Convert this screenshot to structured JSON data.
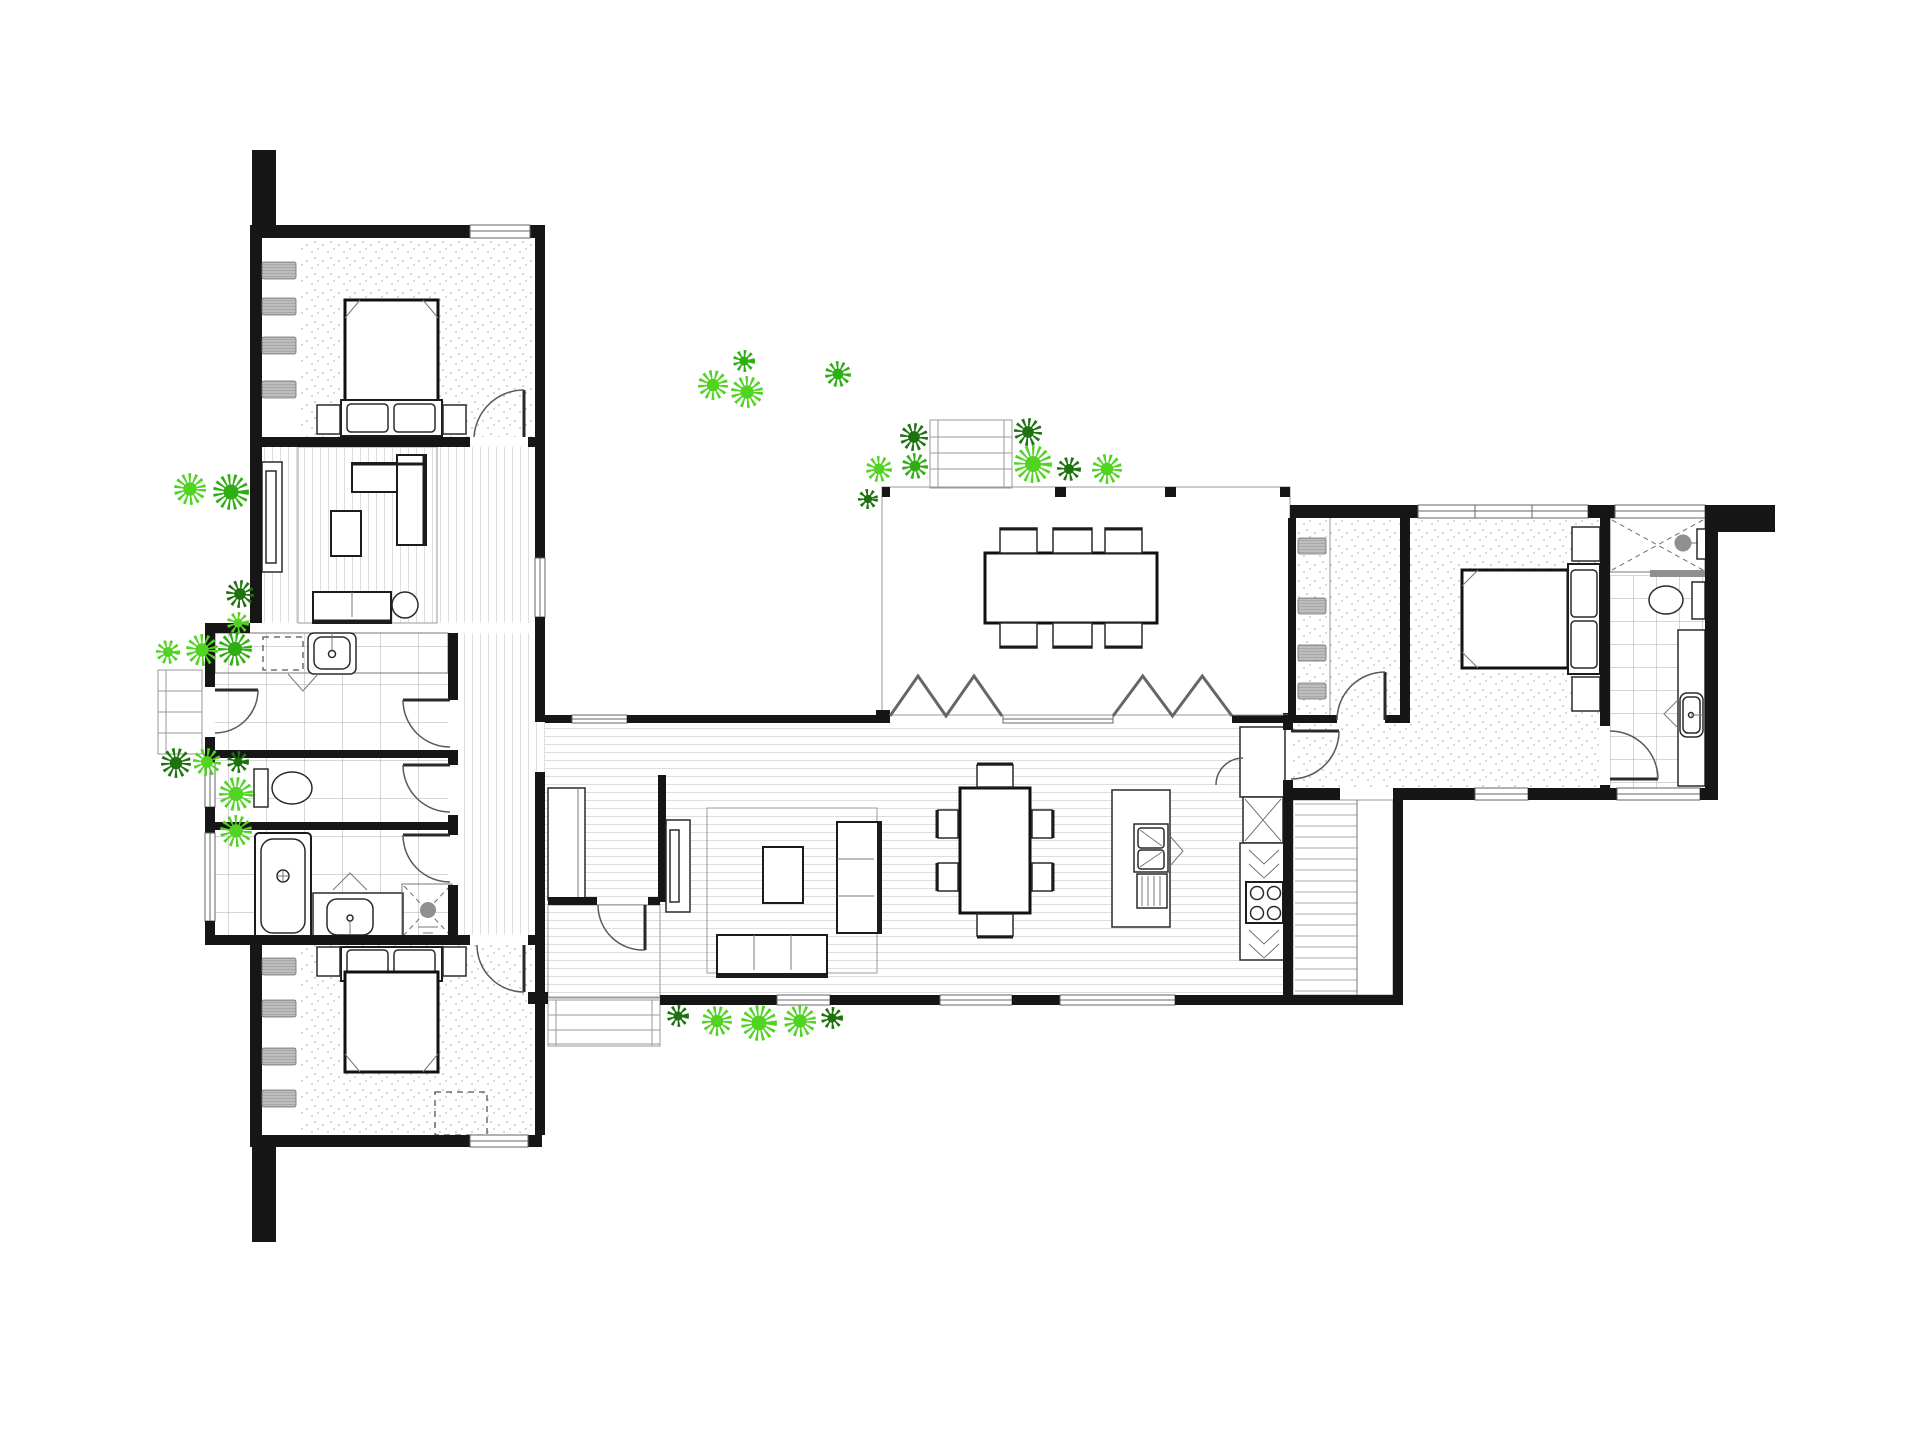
{
  "document": {
    "kind": "architectural floor plan",
    "background": "#ffffff"
  },
  "palette": {
    "wall": "#161616",
    "board": "#c3c3c3",
    "deck": "#b5b5b5",
    "tile": "#aeaeae",
    "carpet_dot": "#c9c9c9",
    "fixture_dark": "#8f8f8f",
    "plant_light": "#50d321",
    "plant_mid": "#2eae12",
    "plant_dark": "#1d730d"
  },
  "plants": [
    {
      "x": 190,
      "y": 489,
      "r": 16,
      "shade": "light"
    },
    {
      "x": 231,
      "y": 492,
      "r": 18,
      "shade": "mid"
    },
    {
      "x": 240,
      "y": 594,
      "r": 14,
      "shade": "dark"
    },
    {
      "x": 238,
      "y": 623,
      "r": 11,
      "shade": "light"
    },
    {
      "x": 168,
      "y": 652,
      "r": 12,
      "shade": "light"
    },
    {
      "x": 202,
      "y": 650,
      "r": 16,
      "shade": "light"
    },
    {
      "x": 235,
      "y": 649,
      "r": 17,
      "shade": "mid"
    },
    {
      "x": 176,
      "y": 763,
      "r": 15,
      "shade": "dark"
    },
    {
      "x": 207,
      "y": 762,
      "r": 14,
      "shade": "light"
    },
    {
      "x": 238,
      "y": 762,
      "r": 11,
      "shade": "dark"
    },
    {
      "x": 236,
      "y": 794,
      "r": 17,
      "shade": "light"
    },
    {
      "x": 236,
      "y": 831,
      "r": 16,
      "shade": "light"
    },
    {
      "x": 713,
      "y": 385,
      "r": 15,
      "shade": "light"
    },
    {
      "x": 744,
      "y": 361,
      "r": 11,
      "shade": "mid"
    },
    {
      "x": 747,
      "y": 392,
      "r": 16,
      "shade": "light"
    },
    {
      "x": 838,
      "y": 374,
      "r": 13,
      "shade": "mid"
    },
    {
      "x": 914,
      "y": 437,
      "r": 14,
      "shade": "dark"
    },
    {
      "x": 879,
      "y": 469,
      "r": 13,
      "shade": "light"
    },
    {
      "x": 915,
      "y": 466,
      "r": 13,
      "shade": "mid"
    },
    {
      "x": 868,
      "y": 499,
      "r": 10,
      "shade": "dark"
    },
    {
      "x": 1028,
      "y": 432,
      "r": 14,
      "shade": "dark"
    },
    {
      "x": 1033,
      "y": 464,
      "r": 19,
      "shade": "light"
    },
    {
      "x": 1069,
      "y": 469,
      "r": 12,
      "shade": "dark"
    },
    {
      "x": 1107,
      "y": 469,
      "r": 15,
      "shade": "light"
    },
    {
      "x": 678,
      "y": 1016,
      "r": 11,
      "shade": "dark"
    },
    {
      "x": 717,
      "y": 1021,
      "r": 15,
      "shade": "light"
    },
    {
      "x": 759,
      "y": 1023,
      "r": 18,
      "shade": "light"
    },
    {
      "x": 800,
      "y": 1021,
      "r": 16,
      "shade": "light"
    },
    {
      "x": 832,
      "y": 1018,
      "r": 11,
      "shade": "dark"
    }
  ],
  "louvre_windows": [
    {
      "x": 262,
      "y": 262,
      "w": 34,
      "h": 17
    },
    {
      "x": 262,
      "y": 298,
      "w": 34,
      "h": 17
    },
    {
      "x": 262,
      "y": 337,
      "w": 34,
      "h": 17
    },
    {
      "x": 262,
      "y": 381,
      "w": 34,
      "h": 17
    },
    {
      "x": 262,
      "y": 958,
      "w": 34,
      "h": 17
    },
    {
      "x": 262,
      "y": 1000,
      "w": 34,
      "h": 17
    },
    {
      "x": 262,
      "y": 1048,
      "w": 34,
      "h": 17
    },
    {
      "x": 262,
      "y": 1090,
      "w": 34,
      "h": 17
    },
    {
      "x": 1298,
      "y": 538,
      "w": 28,
      "h": 16
    },
    {
      "x": 1298,
      "y": 598,
      "w": 28,
      "h": 16
    },
    {
      "x": 1298,
      "y": 645,
      "w": 28,
      "h": 16
    },
    {
      "x": 1298,
      "y": 683,
      "w": 28,
      "h": 16
    }
  ],
  "bifold_doors": [
    {
      "x0": 890,
      "x1": 1002,
      "base": 716,
      "peak": 676
    },
    {
      "x0": 1113,
      "x1": 1232,
      "base": 716,
      "peak": 676
    }
  ]
}
